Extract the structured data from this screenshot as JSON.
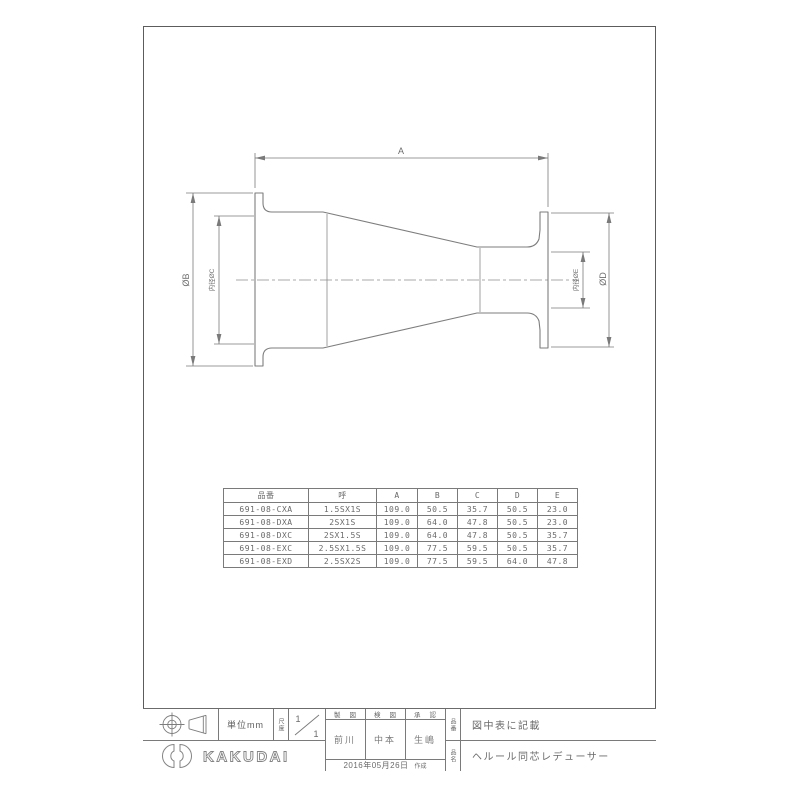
{
  "drawing": {
    "dim_a": "A",
    "dim_b": "ØB",
    "dim_c": "内径ØC",
    "dim_d": "ØD",
    "dim_e": "内径ØE"
  },
  "table": {
    "headers": [
      "品番",
      "呼",
      "A",
      "B",
      "C",
      "D",
      "E"
    ],
    "rows": [
      [
        "691-08-CXA",
        "1.5SX1S",
        "109.0",
        "50.5",
        "35.7",
        "50.5",
        "23.0"
      ],
      [
        "691-08-DXA",
        "2SX1S",
        "109.0",
        "64.0",
        "47.8",
        "50.5",
        "23.0"
      ],
      [
        "691-08-DXC",
        "2SX1.5S",
        "109.0",
        "64.0",
        "47.8",
        "50.5",
        "35.7"
      ],
      [
        "691-08-EXC",
        "2.5SX1.5S",
        "109.0",
        "77.5",
        "59.5",
        "50.5",
        "35.7"
      ],
      [
        "691-08-EXD",
        "2.5SX2S",
        "109.0",
        "77.5",
        "59.5",
        "64.0",
        "47.8"
      ]
    ]
  },
  "title_block": {
    "unit_label": "単位mm",
    "scale_label": "尺度",
    "scale_num": "1",
    "scale_den": "1",
    "drafted_header": "製図",
    "drafted_name": "前川",
    "checked_header": "検図",
    "checked_name": "中本",
    "approved_header": "承認",
    "approved_name": "生嶋",
    "part_no_label": "品番",
    "part_no_value": "図中表に記載",
    "product_label": "品名",
    "product_value": "ヘルール同芯レデューサー",
    "date": "2016年05月26日",
    "created_label": "作成",
    "company": "KAKUDAI"
  }
}
